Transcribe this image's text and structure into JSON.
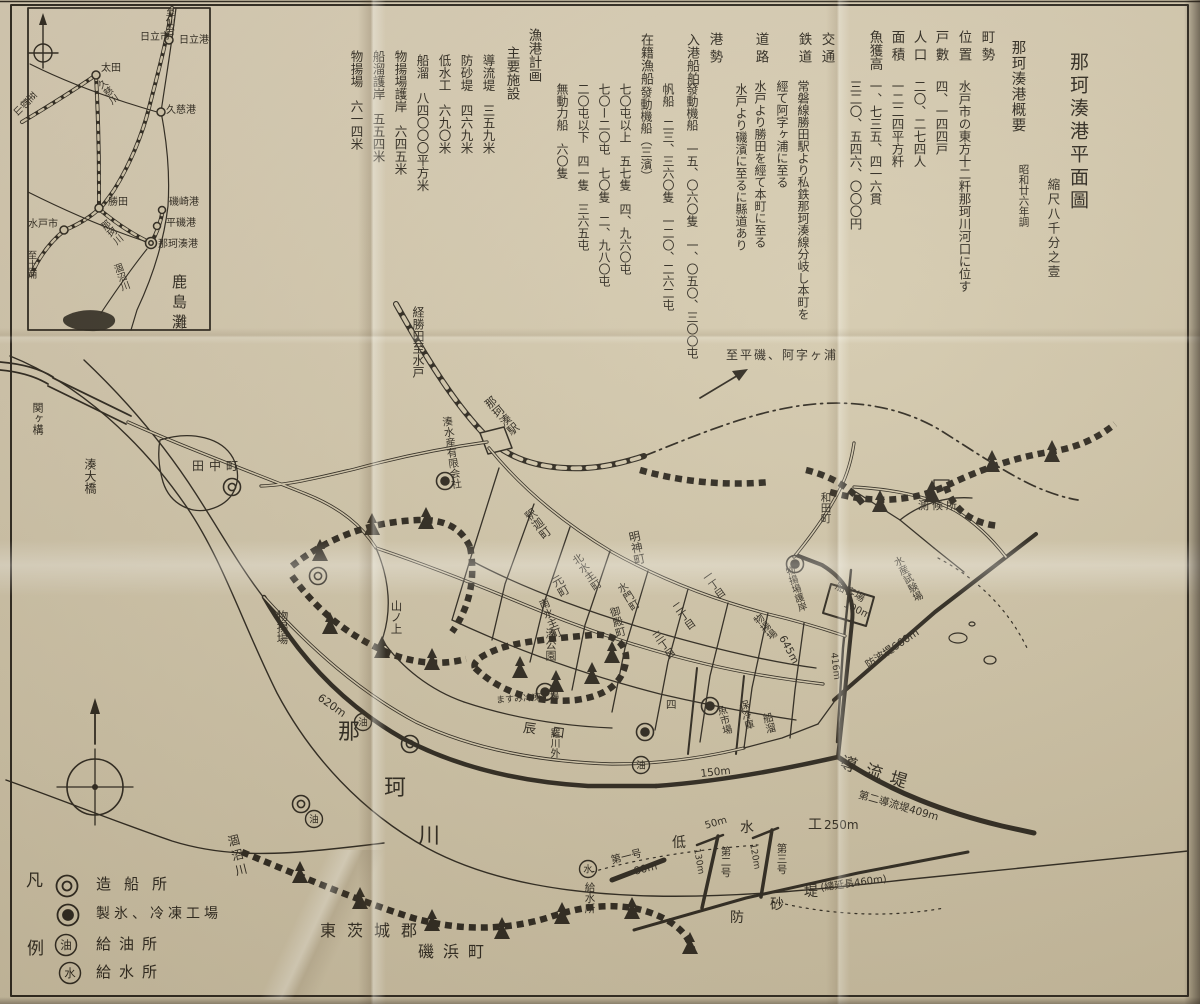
{
  "colors": {
    "paper": "#d2c7ab",
    "ink": "#272219"
  },
  "title": {
    "main": "那珂湊港平面圖",
    "scale": "縮尺八千分之壹"
  },
  "overview": {
    "heading": "那珂湊港概要",
    "survey_note": "昭和廿六年調",
    "columns": [
      {
        "label": "町勢"
      },
      {
        "label": "位置",
        "value": "水戸市の東方十二粁那珂川河口に位す"
      },
      {
        "label": "戸數",
        "value": "四、一四四戸"
      },
      {
        "label": "人口",
        "value": "二〇、二七四人"
      },
      {
        "label": "面積",
        "value": "一二二四平方粁"
      },
      {
        "label": "魚獲高",
        "value": "一、七三五、四一六貫"
      },
      {
        "value": "三二〇、五四六、〇〇〇円"
      },
      {
        "label": "交通"
      },
      {
        "label": "鉄道",
        "value": "常磐線勝田駅より私鉄那珂湊線分岐し本町を"
      },
      {
        "value": "經て阿字ヶ浦に至る"
      },
      {
        "label": "道路",
        "value": "水戸より勝田を經て本町に至る"
      },
      {
        "value": "水戸より磯濱に至るに縣道あり"
      },
      {
        "label": "港勢"
      },
      {
        "label": "入港船舶",
        "value": "發動機船　一五、〇六〇隻　一、〇五〇、三〇〇屯"
      },
      {
        "value": "帆船　二三、三六〇隻　一二〇、二六二屯"
      },
      {
        "label": "在籍漁船",
        "value": "發動機船（三濱）"
      },
      {
        "value": "七〇屯以上　五七隻　四、九六〇屯"
      },
      {
        "value": "七〇ー二〇屯　七〇隻　二、九八〇屯"
      },
      {
        "value": "二〇屯以下　四一隻　三六五屯"
      },
      {
        "value": "無動力船　六〇隻"
      },
      {
        "label": "漁港計画"
      },
      {
        "label": "主要施設"
      },
      {
        "value": "導流堤　三五九米"
      },
      {
        "value": "防砂堤　四六九米"
      },
      {
        "value": "低水工　六九〇米"
      },
      {
        "value": "船溜　八四〇〇〇平方米"
      },
      {
        "value": "物揚場護岸　六四五米"
      },
      {
        "value": "船溜護岸　五五四米"
      },
      {
        "value": "物揚場　六一四米"
      }
    ]
  },
  "inset": {
    "labels": {
      "to_sendai": "至仙台",
      "hitachi_city": "日立市",
      "hitachi_port": "日立港",
      "ota": "太田",
      "kuji_river": "久慈川",
      "to_koriyama": "至郡山",
      "kuji_port": "久慈港",
      "katsuta": "勝田",
      "isozaki_port": "磯崎港",
      "mito_city": "水戸市",
      "naka_river": "那珂川",
      "hiraiso_port": "平磯港",
      "nakaminato_port": "那珂湊港",
      "to_tsuchiura": "至土浦",
      "hinuma_river": "涸沼川",
      "kashima_nada": "鹿島灘"
    }
  },
  "legend": {
    "fan": "凡",
    "rei": "例",
    "oil": "油",
    "water": "水",
    "items": [
      "造船所",
      "製氷、冷凍工場",
      "給油所",
      "給水所"
    ]
  },
  "map": {
    "labels": {
      "sekigamae": "関ヶ構",
      "minato_bridge": "湊大橋",
      "tanaka_cho": "田中町",
      "via_katsuta_to_mito": "経勝田至水戸",
      "nakaminato_station": "那珂湊駅",
      "minato_suisan": "湊水産有限会社",
      "to_hiraiso_ajigaura": "至平磯、阿字ヶ浦",
      "wada_cho": "和田町",
      "weather_station": "測候所",
      "fisheries_station": "水産試験場",
      "myojin_cho": "明神町",
      "shaka_cho": "釈迦町",
      "kita_kako_cho": "北水主町",
      "moto_machi": "元町",
      "suimon_cho": "水門町",
      "goten_cho": "御殿町",
      "minami_kako_cho": "南水主町",
      "minato_park": "湊公園",
      "itchome": "一丁目",
      "nichome": "二丁目",
      "sanchome": "三丁目",
      "yon": "四",
      "yamanoue": "山ノ上",
      "monoageba_west": "物揚場",
      "len_620": "620m",
      "naka_river": [
        "那",
        "珂",
        "川"
      ],
      "hinuma_river": "涸沼川",
      "tatsuguchi": "辰口",
      "rakawa_soto": "羅川外",
      "masumi": "ますみ冷凍工場",
      "fish_market": "魚市場",
      "cold_store": "保冷庫",
      "funadamari": "船溜",
      "monoageba_east": "物揚場",
      "monoageba_gogan": "物揚場護岸",
      "len_645": "645m",
      "len_416": "416m",
      "breakwater_660": "防波堤660m",
      "senkyakuba": "船客場",
      "len_100": "100m",
      "doryutei": "導流堤",
      "daini_doryutei": "第二導流堤409m",
      "len_150": "150m",
      "teisui": [
        "低",
        "水",
        "工"
      ],
      "len_250": "250m",
      "len_50": "50m",
      "groyne1": "第一号",
      "len_80": "80m",
      "groyne2": "第二号",
      "len_130": "130m",
      "groyne3": "第三号",
      "len_120": "120m",
      "bosatei": [
        "防",
        "砂",
        "堤"
      ],
      "total_len": "(總延長460m)",
      "kyusuisho": "給水所",
      "district": "東茨城郡",
      "isohama": "磯浜町"
    }
  }
}
